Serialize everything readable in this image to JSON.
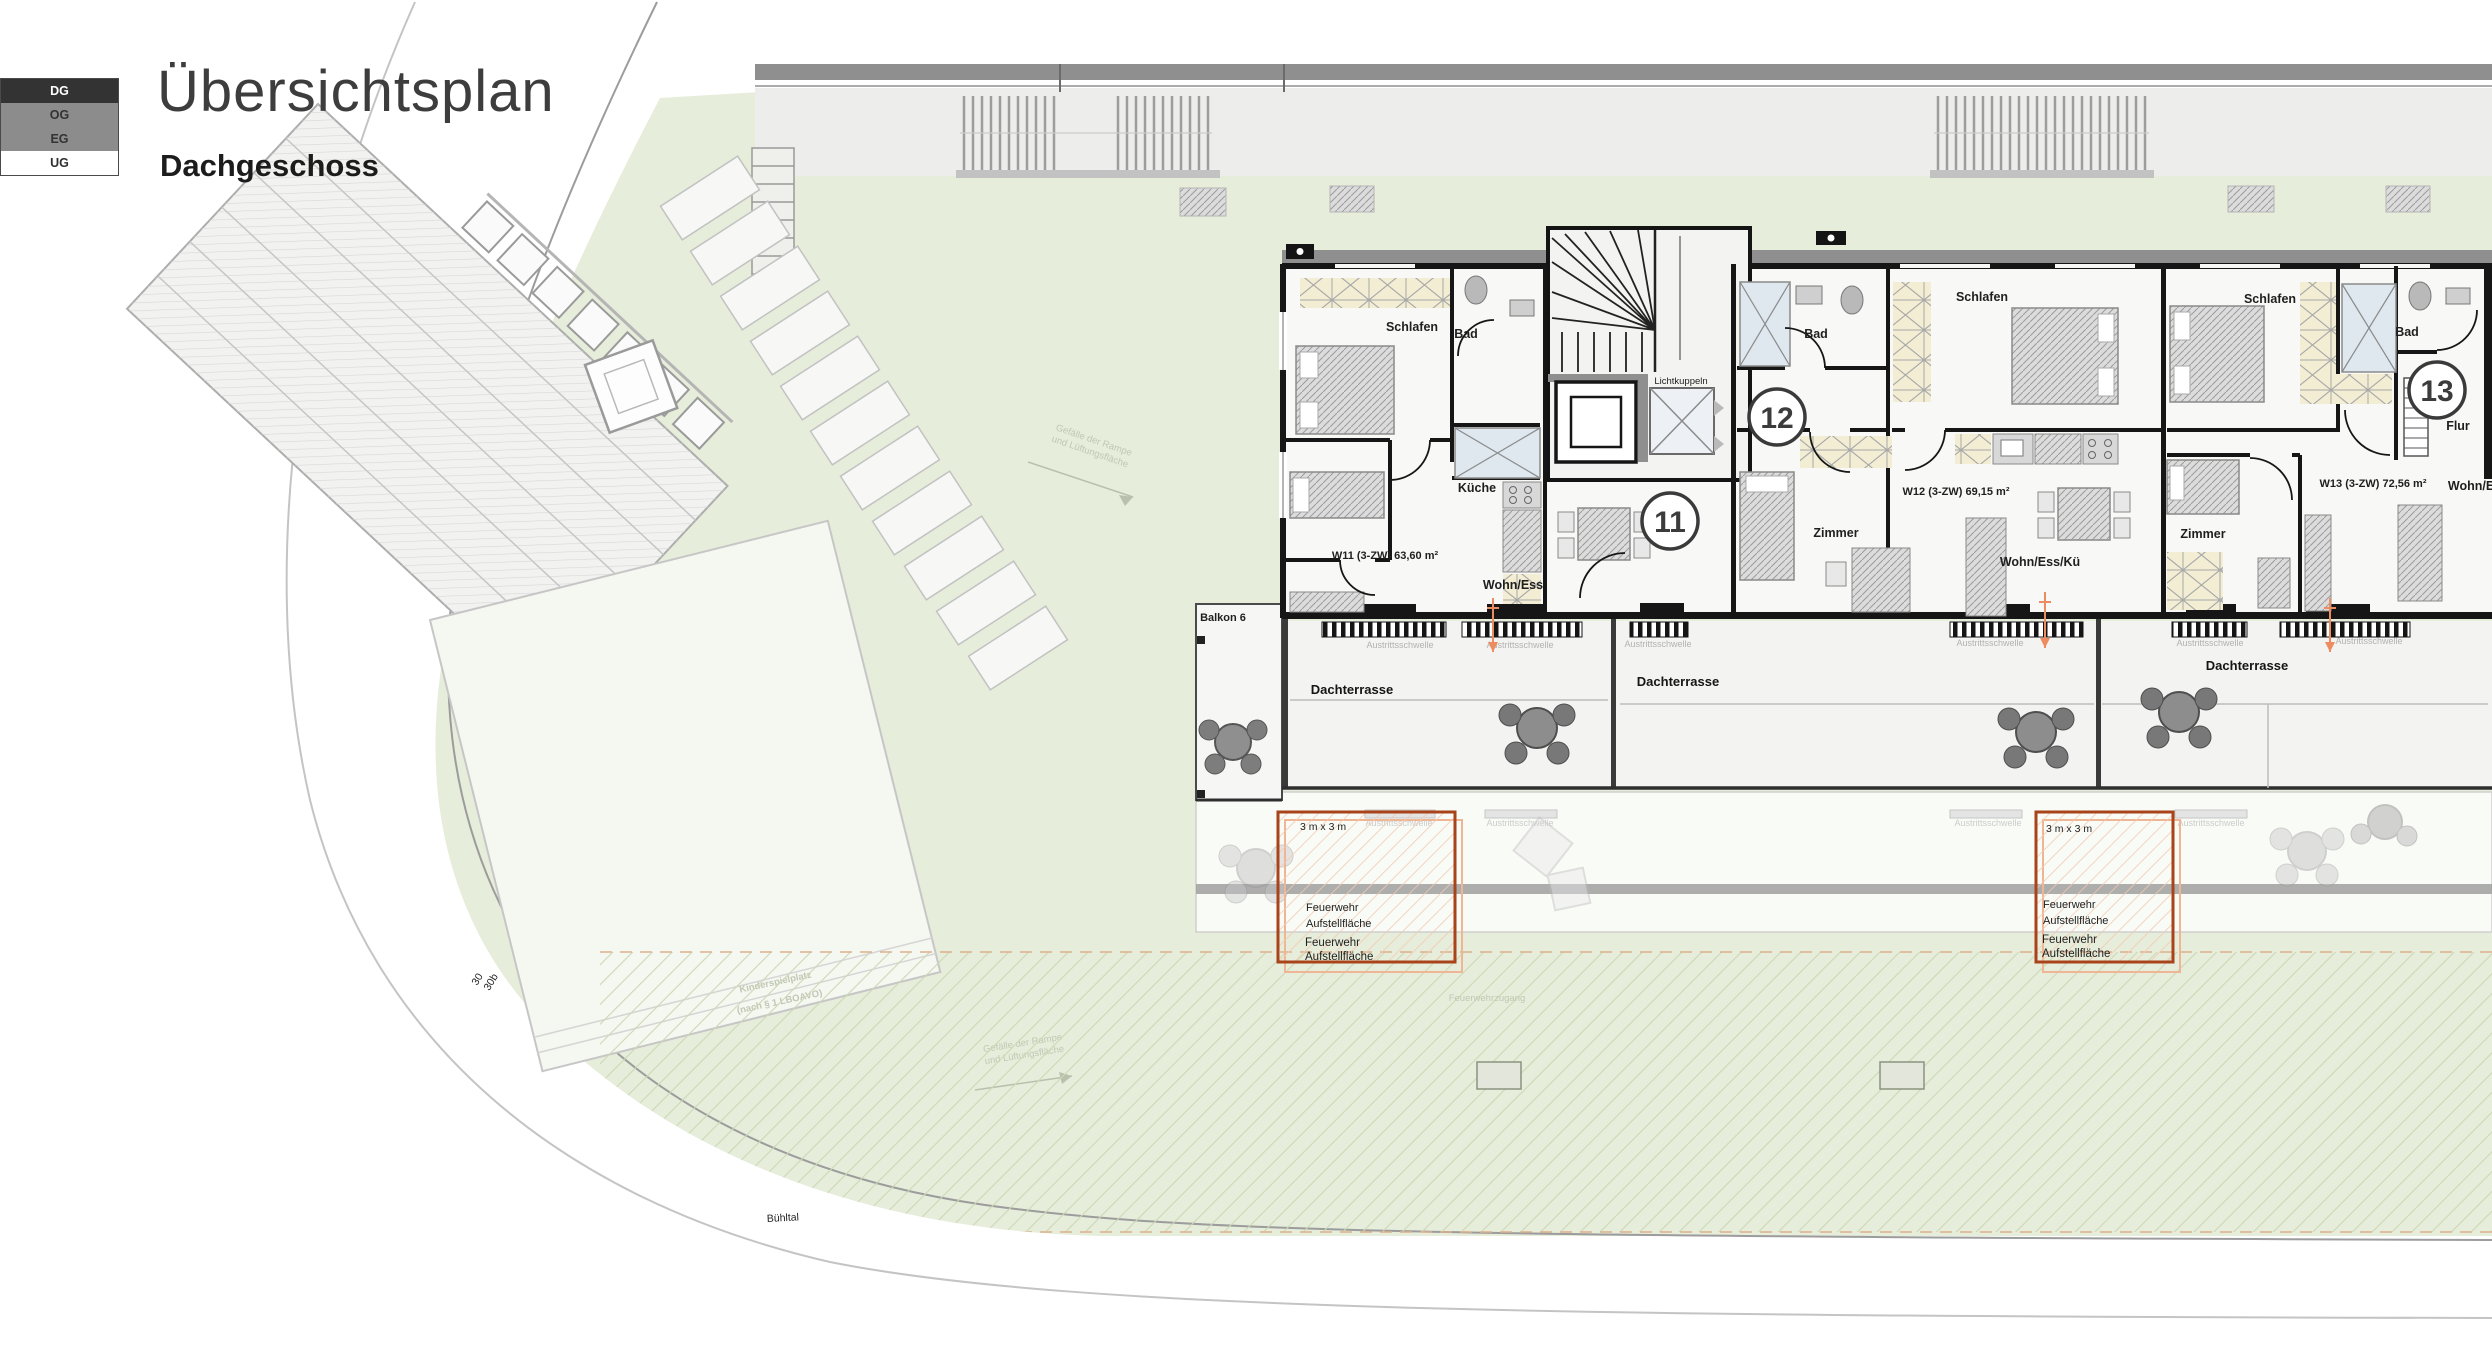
{
  "header": {
    "title": "Übersichtsplan",
    "subtitle": "Dachgeschoss"
  },
  "floor_selector": {
    "active": "DG",
    "items": [
      {
        "label": "DG"
      },
      {
        "label": "OG"
      },
      {
        "label": "EG"
      },
      {
        "label": "UG"
      }
    ]
  },
  "site": {
    "street_name": "Bühltal",
    "house_number_1": "30",
    "house_number_2": "30b",
    "playground_label_line1": "Kinderspielplatz",
    "playground_label_line2": "(nach § 1 LBOAVO)",
    "slope_note_line1": "Gefälle der Rampe",
    "slope_note_line2": "und Lüftungsfläche",
    "fire_access_label": "Feuerwehrzugang"
  },
  "building": {
    "skylight_label": "Lichtkuppeln",
    "balcony_label": "Balkon 6",
    "terrace_label": "Dachterrasse",
    "threshold_label": "Austrittsschwelle",
    "fire_area": {
      "size_label": "3 m x 3 m",
      "line1": "Feuerwehr",
      "line2": "Aufstellfläche"
    },
    "apartments": [
      {
        "circle": "11",
        "area_label": "W11 (3-ZW) 63,60 m²",
        "rooms": {
          "sleep": "Schlafen",
          "bath": "Bad",
          "kitchen": "Küche",
          "living": "Wohn/Ess"
        }
      },
      {
        "circle": "12",
        "area_label": "W12 (3-ZW) 69,15 m²",
        "rooms": {
          "sleep": "Schlafen",
          "bath": "Bad",
          "room": "Zimmer",
          "living": "Wohn/Ess/Kü"
        }
      },
      {
        "circle": "13",
        "area_label": "W13 (3-ZW) 72,56 m²",
        "rooms": {
          "sleep": "Schlafen",
          "bath": "Bad",
          "room": "Zimmer",
          "hall": "Flur",
          "living": "Wohn/Ess"
        }
      }
    ]
  },
  "colors": {
    "selector_active_bg": "#333333",
    "selector_bg": "#8c8c8c",
    "plan_green": "#e6edda",
    "wall_dark": "#161616",
    "accent_orange": "#d95f2b",
    "light_orange": "#f3b79c"
  }
}
